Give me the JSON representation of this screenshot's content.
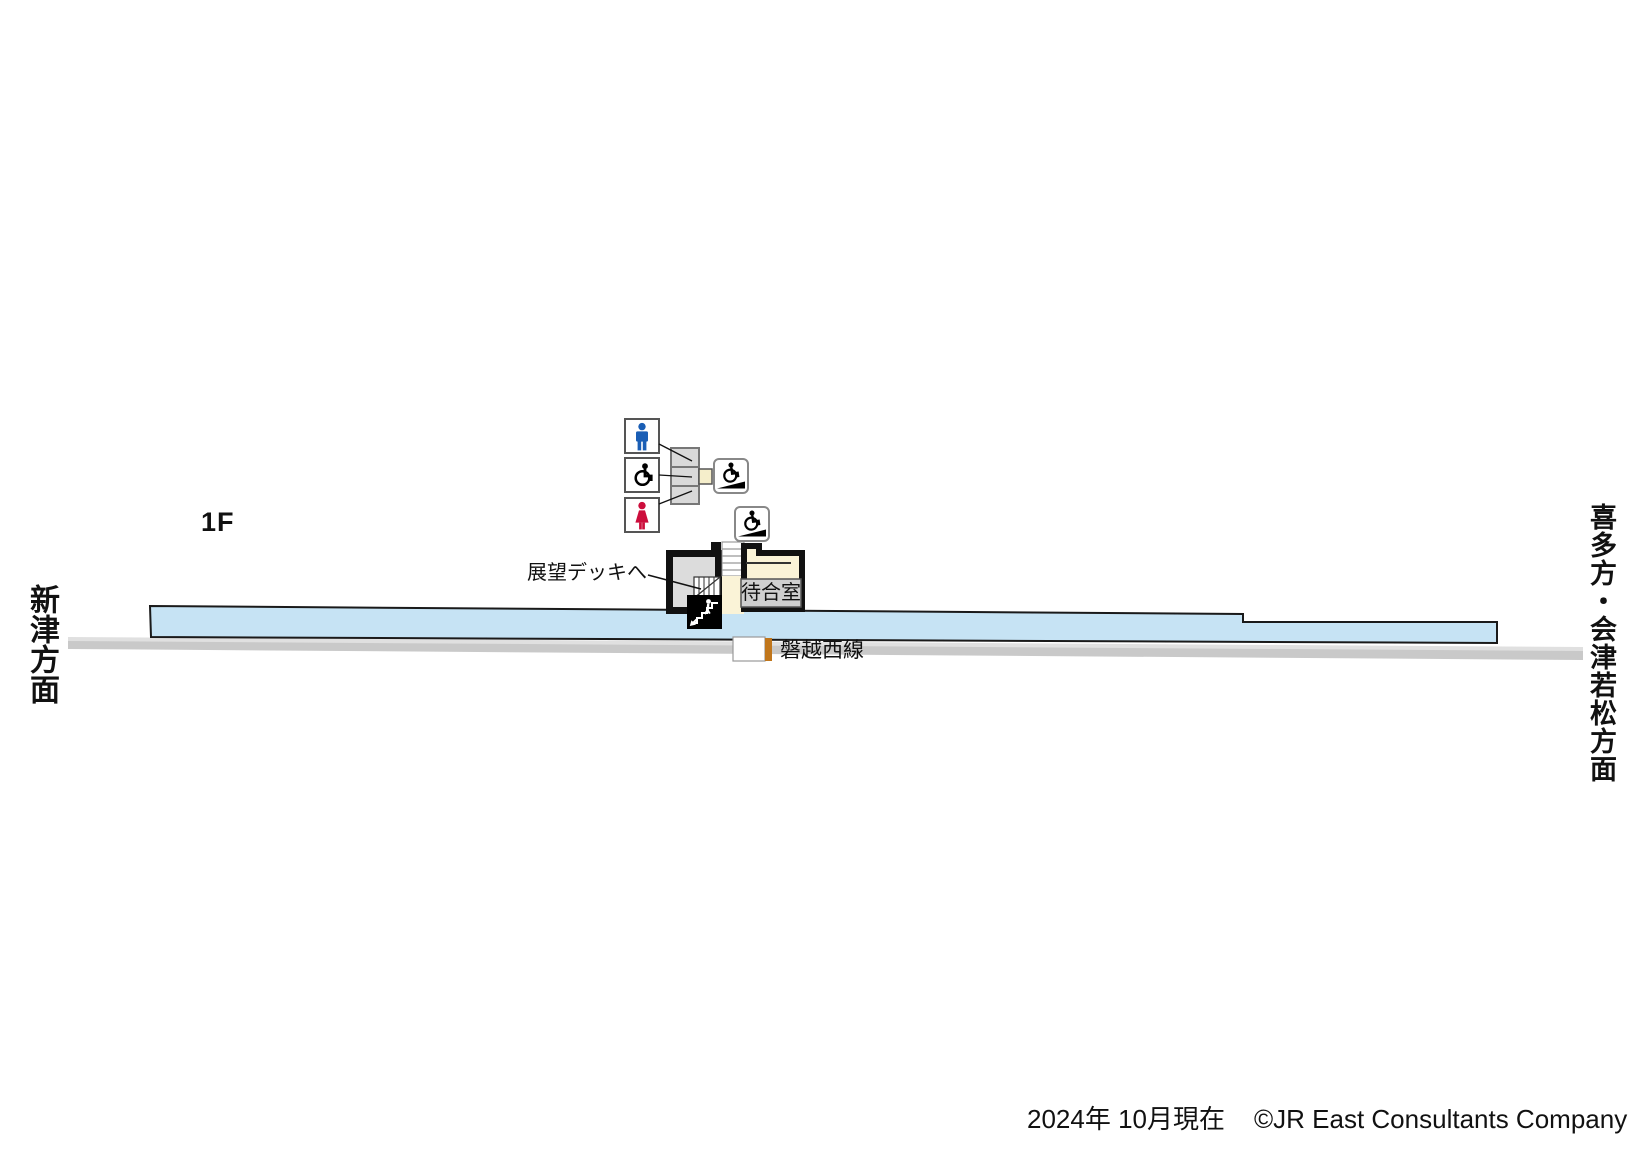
{
  "map": {
    "floor_label": "1F",
    "direction_left": "新津方面",
    "direction_right": "喜多方・会津若松方面",
    "deck_label": "展望デッキへ",
    "waiting_room_label": "待合室",
    "line_label": "磐越西線"
  },
  "footer": {
    "date": "2024年 10月現在",
    "copyright": "©JR East Consultants Company"
  },
  "icons": {
    "male_toilet": "male-toilet-icon",
    "accessible_toilet": "wheelchair-icon",
    "female_toilet": "female-toilet-icon",
    "ramp_entrance": "wheelchair-ramp-icon",
    "stairs": "stairs-icon"
  },
  "colors": {
    "platform": "#c6e3f4",
    "track": "#c9c9c9",
    "track_light": "#e0e0e0",
    "room_fill": "#dcdcdc",
    "cream": "#faf3d7",
    "label_box": "#cfcfcf",
    "toilet_gray": "#d9d9d9",
    "male_blue": "#1a5eb5",
    "female_red": "#cc0e3c",
    "gate_orange": "#c0761c"
  }
}
